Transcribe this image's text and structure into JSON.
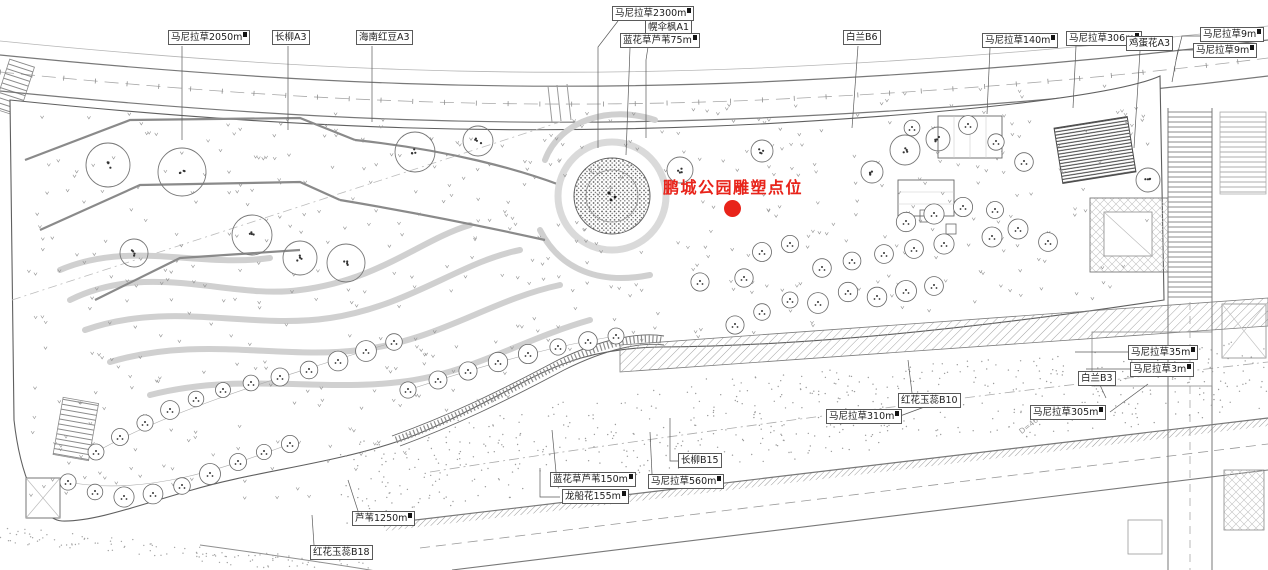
{
  "annotation": {
    "title": "鹏城公园雕塑点位",
    "color": "#e8231a",
    "marker": "red-dot"
  },
  "dimension_note": "D=466.49",
  "labels": [
    {
      "text": "马尼拉草2050m",
      "area": true
    },
    {
      "text": "长柳A3",
      "area": false
    },
    {
      "text": "海南红豆A3",
      "area": false
    },
    {
      "text": "马尼拉草2300m",
      "area": true
    },
    {
      "text": "幌伞枫A1",
      "area": false
    },
    {
      "text": "蓝花草芦苇75m",
      "area": true
    },
    {
      "text": "白兰B6",
      "area": false
    },
    {
      "text": "马尼拉草140m",
      "area": true
    },
    {
      "text": "马尼拉草306m",
      "area": true
    },
    {
      "text": "鸡蛋花A3",
      "area": false
    },
    {
      "text": "马尼拉草9m",
      "area": true
    },
    {
      "text": "马尼拉草9m",
      "area": true
    },
    {
      "text": "马尼拉草35m",
      "area": true
    },
    {
      "text": "马尼拉草3m",
      "area": true
    },
    {
      "text": "白兰B3",
      "area": false
    },
    {
      "text": "红花玉蕊B10",
      "area": false
    },
    {
      "text": "马尼拉草310m",
      "area": true
    },
    {
      "text": "马尼拉草305m",
      "area": true
    },
    {
      "text": "长柳B15",
      "area": false
    },
    {
      "text": "马尼拉草560m",
      "area": true
    },
    {
      "text": "蓝花草芦苇150m",
      "area": true
    },
    {
      "text": "龙船花155m",
      "area": true
    },
    {
      "text": "芦苇1250m",
      "area": true
    },
    {
      "text": "红花玉蕊B18",
      "area": false
    }
  ]
}
